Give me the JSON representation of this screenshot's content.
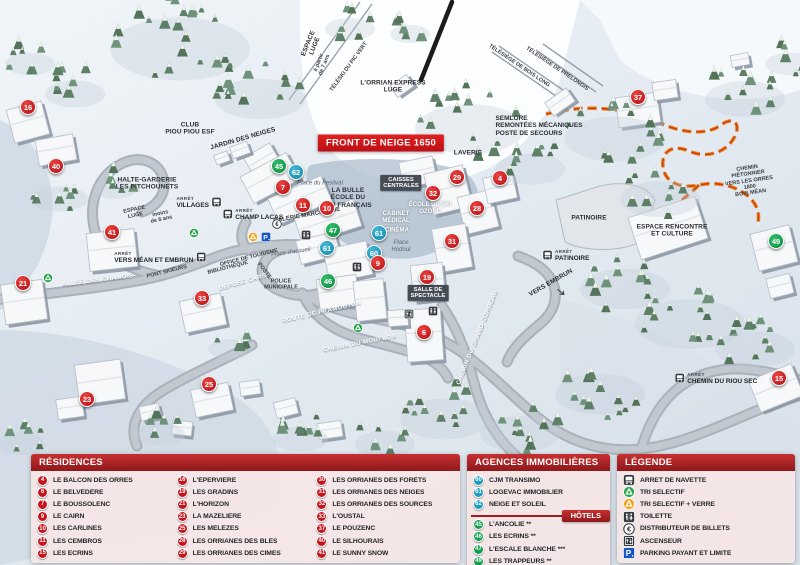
{
  "map": {
    "banner": {
      "text": "FRONT DE NEIGE 1650",
      "x": 381,
      "y": 143
    },
    "arret_label": "ARRÊT",
    "markers": [
      {
        "n": "16",
        "c": "r",
        "x": 28,
        "y": 107
      },
      {
        "n": "40",
        "c": "r",
        "x": 56,
        "y": 166
      },
      {
        "n": "41",
        "c": "r",
        "x": 112,
        "y": 232
      },
      {
        "n": "21",
        "c": "r",
        "x": 23,
        "y": 283
      },
      {
        "n": "33",
        "c": "r",
        "x": 202,
        "y": 298
      },
      {
        "n": "23",
        "c": "r",
        "x": 87,
        "y": 399
      },
      {
        "n": "25",
        "c": "r",
        "x": 209,
        "y": 384
      },
      {
        "n": "45",
        "c": "g",
        "x": 279,
        "y": 166
      },
      {
        "n": "62",
        "c": "b",
        "x": 296,
        "y": 172
      },
      {
        "n": "7",
        "c": "r",
        "x": 283,
        "y": 187
      },
      {
        "n": "11",
        "c": "r",
        "x": 303,
        "y": 205
      },
      {
        "n": "10",
        "c": "r",
        "x": 327,
        "y": 208
      },
      {
        "n": "47",
        "c": "g",
        "x": 333,
        "y": 230
      },
      {
        "n": "61",
        "c": "b",
        "x": 379,
        "y": 233
      },
      {
        "n": "61",
        "c": "b",
        "x": 327,
        "y": 248
      },
      {
        "n": "60",
        "c": "b",
        "x": 374,
        "y": 253
      },
      {
        "n": "9",
        "c": "r",
        "x": 378,
        "y": 263
      },
      {
        "n": "46",
        "c": "g",
        "x": 328,
        "y": 281
      },
      {
        "n": "29",
        "c": "r",
        "x": 457,
        "y": 177
      },
      {
        "n": "4",
        "c": "r",
        "x": 500,
        "y": 178
      },
      {
        "n": "32",
        "c": "r",
        "x": 433,
        "y": 193
      },
      {
        "n": "28",
        "c": "r",
        "x": 477,
        "y": 208
      },
      {
        "n": "31",
        "c": "r",
        "x": 452,
        "y": 241
      },
      {
        "n": "19",
        "c": "r",
        "x": 427,
        "y": 277
      },
      {
        "n": "6",
        "c": "r",
        "x": 424,
        "y": 332
      },
      {
        "n": "37",
        "c": "r",
        "x": 638,
        "y": 97
      },
      {
        "n": "49",
        "c": "g",
        "x": 776,
        "y": 241
      },
      {
        "n": "15",
        "c": "r",
        "x": 779,
        "y": 378
      }
    ],
    "labels": [
      {
        "t": "CLUB\nPIOU PIOU ESF",
        "x": 190,
        "y": 129,
        "r": 0,
        "s": "dark"
      },
      {
        "t": "JARDIN DES NEIGES",
        "x": 243,
        "y": 139,
        "r": -16,
        "s": "dark"
      },
      {
        "t": "ESPACE\nLUGE",
        "x": 312,
        "y": 45,
        "r": -68,
        "s": "dark"
      },
      {
        "t": "à partir\nde 7 ans",
        "x": 322,
        "y": 64,
        "r": -68,
        "s": "tiny"
      },
      {
        "t": "TÉLÉSKI DU PIC VERT",
        "x": 349,
        "y": 67,
        "r": -54,
        "s": "tiny"
      },
      {
        "t": "L'ORRIAN EXPRESS\nLUGE",
        "x": 393,
        "y": 87,
        "r": 0,
        "s": "dark"
      },
      {
        "t": "TÉLÉSIÈGE DE BOIS LONG",
        "x": 519,
        "y": 66,
        "r": 34,
        "s": "tiny"
      },
      {
        "t": "TÉLÉSIÈGE DE PRÉLONGIS",
        "x": 557,
        "y": 69,
        "r": 34,
        "s": "tiny"
      },
      {
        "t": "SEMLORE\nREMONTÉES MÉCANIQUES\nPOSTE DE SECOURS",
        "x": 539,
        "y": 126,
        "r": 0,
        "s": "dark-left"
      },
      {
        "t": "CHEMIN PIÉTONNIER\nVERS LES ORRES 1800\nBOIS MÉAN",
        "x": 749,
        "y": 181,
        "r": -8,
        "s": "tiny"
      },
      {
        "t": "HALTE-GARDERIE\nLES PITCHOUNETS",
        "x": 147,
        "y": 184,
        "r": 0,
        "s": "dark"
      },
      {
        "t": "ESPACE\nLUGE",
        "x": 135,
        "y": 213,
        "r": -12,
        "s": "tiny"
      },
      {
        "t": "moins\nde 6 ans",
        "x": 161,
        "y": 217,
        "r": -12,
        "s": "tiny"
      },
      {
        "t": "Place du Festival",
        "x": 320,
        "y": 184,
        "r": 0,
        "s": "italic"
      },
      {
        "t": "LA BULLE\nÉCOLE DU\nSKI FRANÇAIS",
        "x": 348,
        "y": 198,
        "r": 0,
        "s": "dark"
      },
      {
        "t": "CAISSES\nCENTRALES",
        "x": 401,
        "y": 183,
        "r": 0,
        "s": "darkbox"
      },
      {
        "t": "LAVERIE",
        "x": 468,
        "y": 153,
        "r": 0,
        "s": "dark"
      },
      {
        "t": "ÉCOLE DE SKI\nOZONE",
        "x": 430,
        "y": 209,
        "r": 0,
        "s": "white"
      },
      {
        "t": "CABINET\nMÉDICAL",
        "x": 396,
        "y": 218,
        "r": 0,
        "s": "white"
      },
      {
        "t": "CINÉMA",
        "x": 397,
        "y": 231,
        "r": 0,
        "s": "white"
      },
      {
        "t": "Place\nHodoul",
        "x": 401,
        "y": 247,
        "r": 0,
        "s": "italic"
      },
      {
        "t": "Place d'accueil",
        "x": 291,
        "y": 253,
        "r": -8,
        "s": "italic"
      },
      {
        "t": "GALERIE MARCHANDE",
        "x": 307,
        "y": 216,
        "r": -10,
        "s": "dark-sm"
      },
      {
        "t": "OFFICE DE TOURISME",
        "x": 249,
        "y": 258,
        "r": -14,
        "s": "tiny"
      },
      {
        "t": "BIBLIOTHÈQUE",
        "x": 228,
        "y": 268,
        "r": -14,
        "s": "tiny"
      },
      {
        "t": "POSTE",
        "x": 264,
        "y": 271,
        "r": 52,
        "s": "tiny"
      },
      {
        "t": "DÉPOSE CARS",
        "x": 243,
        "y": 283,
        "r": -16,
        "s": "road"
      },
      {
        "t": "POLICE\nMUNICIPALE",
        "x": 281,
        "y": 285,
        "r": 0,
        "s": "tiny"
      },
      {
        "t": "PONT SKIEURS",
        "x": 167,
        "y": 272,
        "r": -14,
        "s": "tiny"
      },
      {
        "t": "ALLÉE DES CHAMOIS",
        "x": 98,
        "y": 281,
        "r": -7,
        "s": "road"
      },
      {
        "t": "ROUTE DE PRAMOUTON",
        "x": 322,
        "y": 313,
        "r": -13,
        "s": "road"
      },
      {
        "t": "CHEMIN DU MOUFLON",
        "x": 360,
        "y": 344,
        "r": -11,
        "s": "road"
      },
      {
        "t": "CHEMIN DU GRAND CORBEAU",
        "x": 478,
        "y": 338,
        "r": -68,
        "s": "road"
      },
      {
        "t": "SALLE DE\nSPECTACLE",
        "x": 428,
        "y": 293,
        "r": 0,
        "s": "darkbox"
      },
      {
        "t": "PATINOIRE",
        "x": 589,
        "y": 218,
        "r": 0,
        "s": "dark"
      },
      {
        "t": "VERS EMBRUN",
        "x": 551,
        "y": 283,
        "r": -30,
        "s": "dark"
      },
      {
        "t": "ESPACE RENCONTRE\nET CULTURE",
        "x": 672,
        "y": 231,
        "r": 0,
        "s": "dark"
      }
    ],
    "bus_stops": [
      {
        "name": "VILLAGES",
        "x": 199,
        "y": 203,
        "icon_after": true
      },
      {
        "name": "CHAMP LACAS",
        "x": 253,
        "y": 215,
        "icon_after": false
      },
      {
        "name": "VERS MÉAN ET EMBRUN",
        "x": 160,
        "y": 258,
        "icon_after": true
      },
      {
        "name": "PATINOIRE",
        "x": 566,
        "y": 256,
        "icon_after": false
      },
      {
        "name": "CHEMIN DU RIOU SEC",
        "x": 716,
        "y": 379,
        "icon_after": false
      }
    ],
    "icons": [
      {
        "type": "tri-green",
        "x": 48,
        "y": 278
      },
      {
        "type": "tri-green",
        "x": 194,
        "y": 233
      },
      {
        "type": "tri-green",
        "x": 358,
        "y": 328
      },
      {
        "type": "tri-orange",
        "x": 253,
        "y": 237
      },
      {
        "type": "parking",
        "x": 266,
        "y": 237
      },
      {
        "type": "euro",
        "x": 277,
        "y": 224
      },
      {
        "type": "toilet",
        "x": 306,
        "y": 235
      },
      {
        "type": "toilet",
        "x": 357,
        "y": 267
      },
      {
        "type": "toilet",
        "x": 433,
        "y": 311
      },
      {
        "type": "elevator",
        "x": 409,
        "y": 314
      },
      {
        "type": "arrow-se",
        "x": 561,
        "y": 292
      }
    ]
  },
  "panels": {
    "residences": {
      "title": "RÉSIDENCES",
      "columns": [
        [
          {
            "n": "4",
            "label": "LE BALCON DES ORRES"
          },
          {
            "n": "6",
            "label": "LE BELVÉDÈRE"
          },
          {
            "n": "7",
            "label": "LE BOUSSOLENC"
          },
          {
            "n": "9",
            "label": "LE CAIRN"
          },
          {
            "n": "10",
            "label": "LES CARLINES"
          },
          {
            "n": "11",
            "label": "LES CEMBROS"
          },
          {
            "n": "15",
            "label": "LES ÉCRINS"
          }
        ],
        [
          {
            "n": "16",
            "label": "L'ÉPERVIÈRE"
          },
          {
            "n": "19",
            "label": "LES GRADINS"
          },
          {
            "n": "21",
            "label": "L'HORIZON"
          },
          {
            "n": "23",
            "label": "LA MAZELIÈRE"
          },
          {
            "n": "25",
            "label": "LES MÉLÈZES"
          },
          {
            "n": "28",
            "label": "LES ORRIANES DES BLÉS"
          },
          {
            "n": "29",
            "label": "LES ORRIANES DES CIMES"
          }
        ],
        [
          {
            "n": "30",
            "label": "LES ORRIANES DES FORÊTS"
          },
          {
            "n": "31",
            "label": "LES ORRIANES DES NEIGES"
          },
          {
            "n": "32",
            "label": "LES ORRIANES DES SOURCES"
          },
          {
            "n": "33",
            "label": "L'OUSTAL"
          },
          {
            "n": "37",
            "label": "LE POUZENC"
          },
          {
            "n": "40",
            "label": "LE SILHOURAÏS"
          },
          {
            "n": "41",
            "label": "LE SUNNY SNOW"
          }
        ]
      ]
    },
    "agences": {
      "title": "AGENCES IMMOBILIÈRES",
      "items": [
        {
          "n": "60",
          "label": "CJM TRANSIMO"
        },
        {
          "n": "61",
          "label": "LOGEVAC IMMOBILIER"
        },
        {
          "n": "62",
          "label": "NEIGE ET SOLEIL"
        }
      ]
    },
    "hotels": {
      "title": "HÔTELS",
      "items": [
        {
          "n": "45",
          "label": "L'ANCOLIE **"
        },
        {
          "n": "46",
          "label": "LES ECRINS **"
        },
        {
          "n": "47",
          "label": "L'ESCALE BLANCHE ***"
        },
        {
          "n": "49",
          "label": "LES TRAPPEURS **"
        }
      ]
    },
    "legende": {
      "title": "LÉGENDE",
      "items": [
        {
          "icon": "bus",
          "label": "ARRET DE NAVETTE"
        },
        {
          "icon": "tri-green",
          "label": "TRI SELECTIF"
        },
        {
          "icon": "tri-orange",
          "label": "TRI SELECTIF + VERRE"
        },
        {
          "icon": "toilet",
          "label": "TOILETTE"
        },
        {
          "icon": "euro",
          "label": "DISTRIBUTEUR DE BILLETS"
        },
        {
          "icon": "elevator",
          "label": "ASCENSEUR"
        },
        {
          "icon": "parking",
          "label": "PARKING PAYANT ET LIMITÉ"
        }
      ]
    }
  },
  "colors": {
    "residence": "#c8131b",
    "agence": "#1b9cc0",
    "hotel": "#12a04e",
    "panel_header": "#a81d21",
    "panel_body": "#f5e6e6",
    "path_orange": "#ed7d12"
  }
}
